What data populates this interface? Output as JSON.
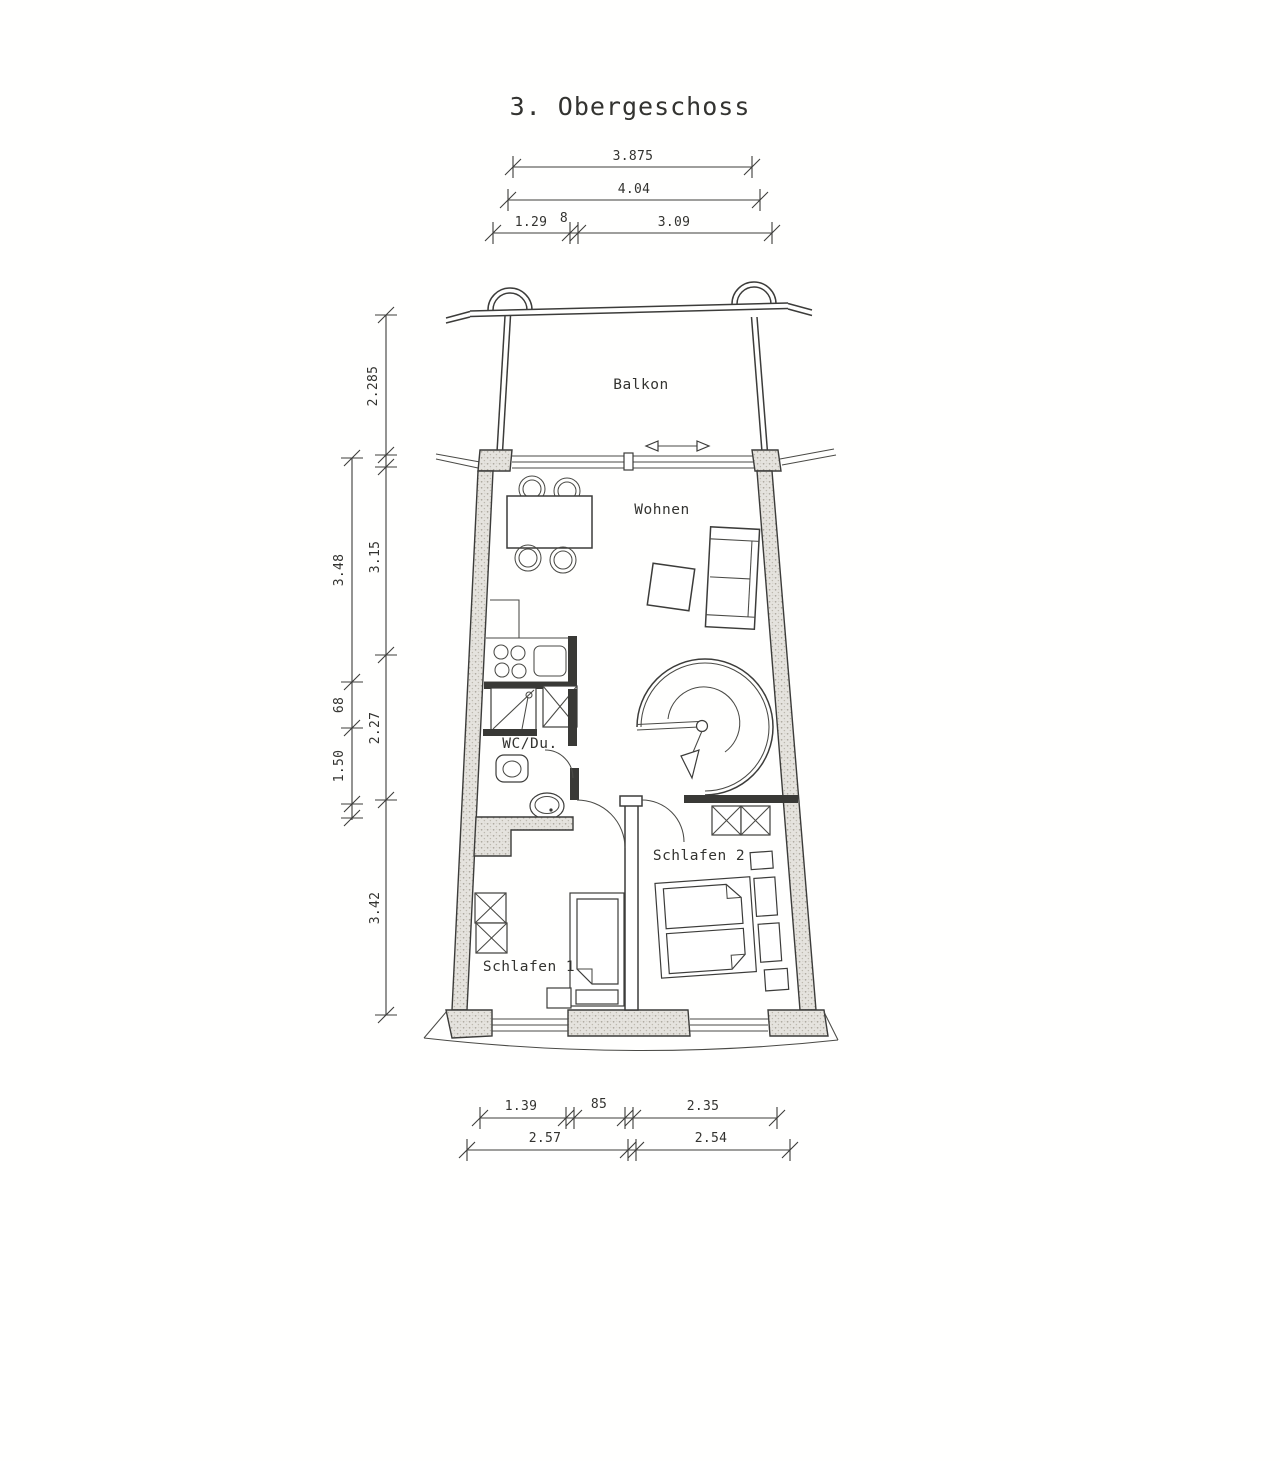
{
  "title": "3. Obergeschoss",
  "rooms": {
    "balkon": "Balkon",
    "wohnen": "Wohnen",
    "wc_du": "WC/Du.",
    "schlafen_1": "Schlafen 1",
    "schlafen_2": "Schlafen 2"
  },
  "dimensions": {
    "top_row_1": [
      "3.875"
    ],
    "top_row_2": [
      "4.04"
    ],
    "top_row_3": [
      "1.29",
      "8",
      "3.09"
    ],
    "left_inner": [
      "2.285",
      "3.15",
      "2.27",
      "3.42"
    ],
    "left_outer": [
      "3.48",
      "68",
      "1.50"
    ],
    "bottom_row_1": [
      "1.39",
      "85",
      "2.35"
    ],
    "bottom_row_2": [
      "2.57",
      "2.54"
    ]
  },
  "icons": {
    "sliding_door_arrow": "double-headed-arrow",
    "stair_direction_arrow": "curved-down-arrow",
    "shaft_marker": "x-crossed-box"
  },
  "colors": {
    "line": "#3c3c3a",
    "wall_fill": "#e5e3de",
    "wall_speckle": "#a9a59b",
    "paper": "#fffffe"
  }
}
